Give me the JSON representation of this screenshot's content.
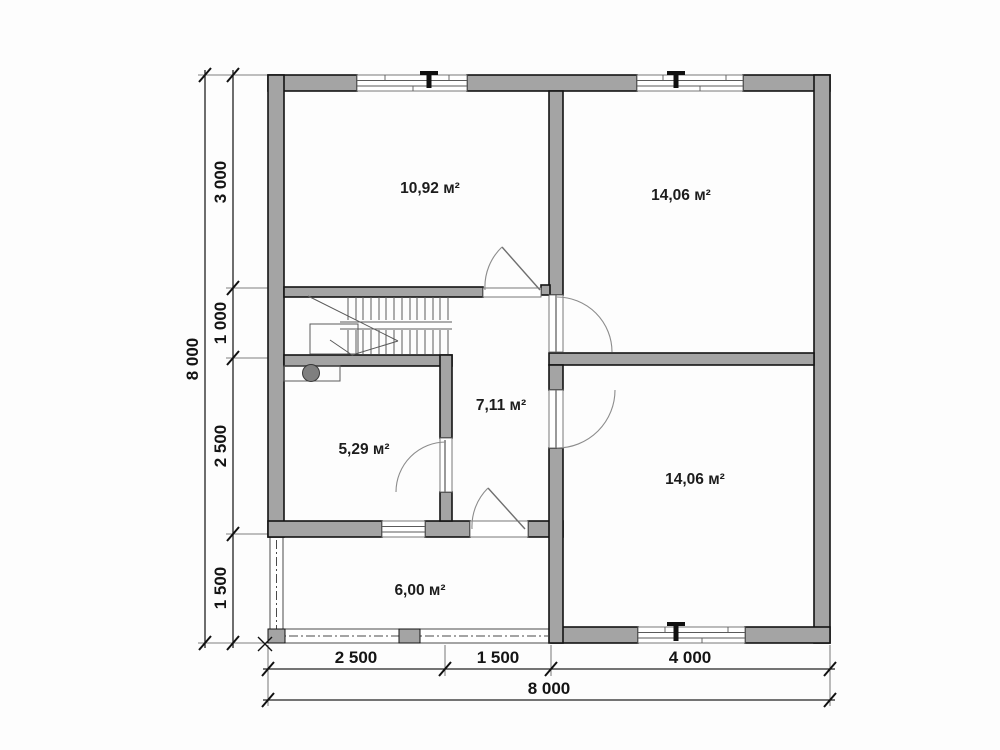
{
  "plan": {
    "type": "floor-plan",
    "rooms": [
      {
        "id": "room-top-left",
        "area": "10,92 м²"
      },
      {
        "id": "room-top-right",
        "area": "14,06 м²"
      },
      {
        "id": "hallway",
        "area": "7,11 м²"
      },
      {
        "id": "room-small",
        "area": "5,29 м²"
      },
      {
        "id": "room-bottom-right",
        "area": "14,06 м²"
      },
      {
        "id": "terrace",
        "area": "6,00 м²"
      }
    ],
    "dimensions": {
      "left": [
        "3 000",
        "1 000",
        "2 500",
        "1 500"
      ],
      "left_total": "8 000",
      "bottom": [
        "2 500",
        "1 500",
        "4 000"
      ],
      "bottom_total": "8 000"
    },
    "colors": {
      "wall_fill": "#a4a4a4",
      "outline": "#141414",
      "thin_line": "#5a5a5a",
      "background": "#fdfdfd"
    }
  }
}
